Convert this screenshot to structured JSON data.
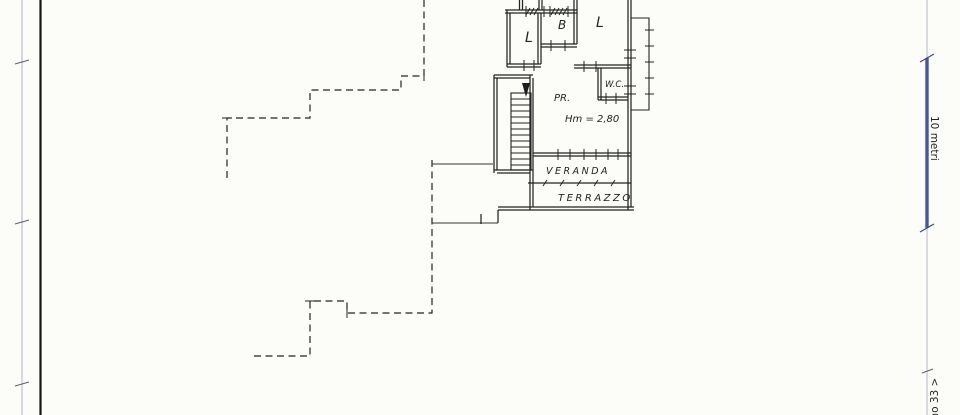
{
  "sheet": {
    "paper_color": "#fcfcf9",
    "ink_color": "#232323"
  },
  "plan": {
    "rooms": [
      {
        "label": "L"
      },
      {
        "label": "B"
      },
      {
        "label": "L"
      },
      {
        "label": "PR."
      },
      {
        "label": "W.C."
      },
      {
        "label": "VERANDA"
      },
      {
        "label": "TERRAZZO"
      }
    ],
    "height_annotation": "Hm = 2,80"
  },
  "margin": {
    "scale_label": "10 metri",
    "scale_bar_color": "#4a55a2",
    "corner_note": "ano 33 >"
  }
}
